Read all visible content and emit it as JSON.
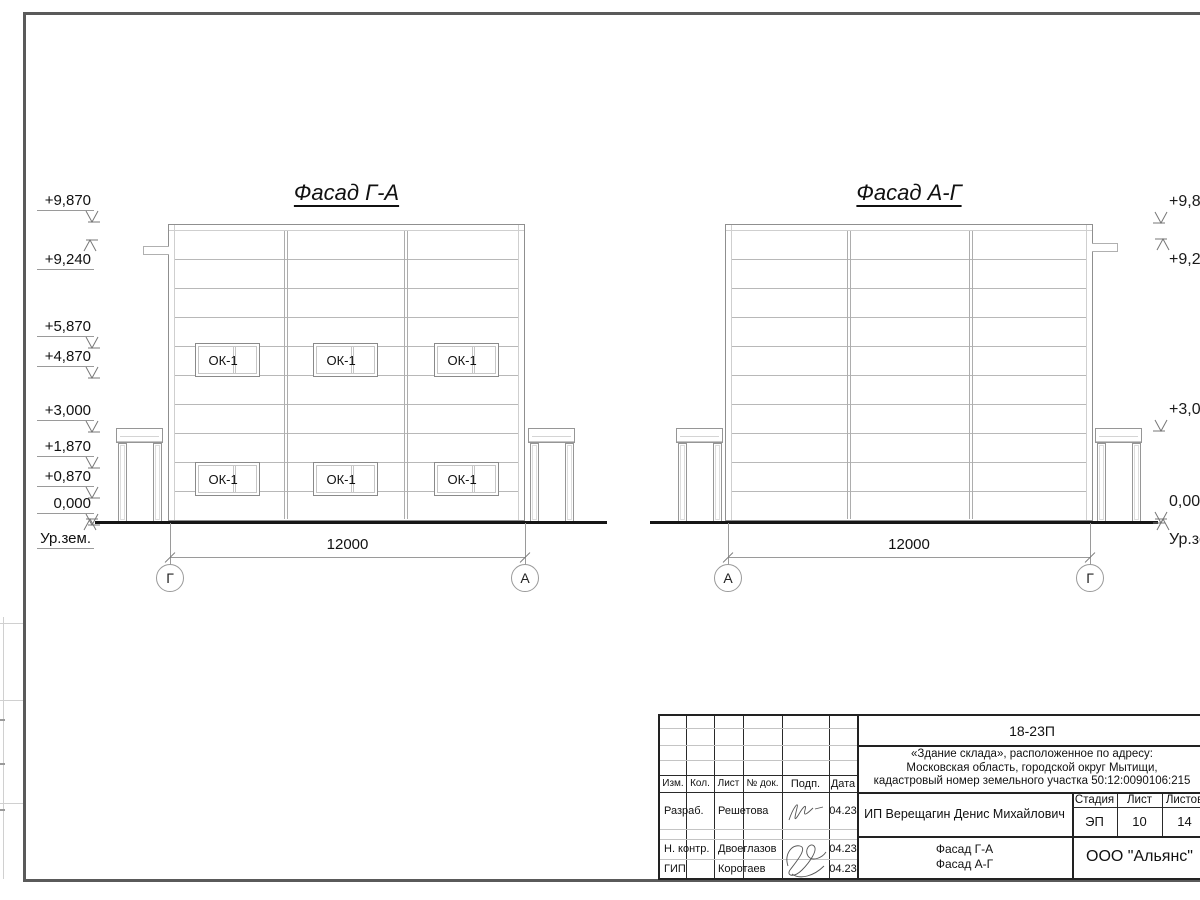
{
  "drawing": {
    "facades": [
      {
        "title": "Фасад Г-А",
        "axis_left": "Г",
        "axis_right": "А",
        "dimension": "12000",
        "window_label": "ОК-1"
      },
      {
        "title": "Фасад А-Г",
        "axis_left": "А",
        "axis_right": "Г",
        "dimension": "12000"
      }
    ],
    "elevations_left": [
      "+9,870",
      "+9,240",
      "+5,870",
      "+4,870",
      "+3,000",
      "+1,870",
      "+0,870",
      "0,000",
      "Ур.зем."
    ],
    "elevations_right": [
      "+9,870",
      "+9,240",
      "+3,000",
      "0,000",
      "Ур.зем."
    ]
  },
  "title_block": {
    "code": "18-23П",
    "project_description": "«Здание склада», расположенное по адресу:\nМосковская область, городской округ Мытищи,\nкадастровый номер земельного участка 50:12:0090106:215",
    "client": "ИП Верещагин Денис Михайлович",
    "sheet_title": "Фасад Г-А\nФасад А-Г",
    "organization": "ООО \"Альянс\"",
    "stage_label": "Стадия",
    "stage_value": "ЭП",
    "sheet_label": "Лист",
    "sheet_value": "10",
    "sheets_label": "Листов",
    "sheets_value": "14",
    "rev_columns": [
      "Изм.",
      "Кол.",
      "Лист",
      "№ док.",
      "Подп.",
      "Дата"
    ],
    "signers": [
      {
        "role": "Разраб.",
        "name": "Решетова",
        "date": "04.23"
      },
      {
        "role": "Н. контр.",
        "name": "Двоеглазов",
        "date": "04.23"
      },
      {
        "role": "ГИП",
        "name": "Коротаев",
        "date": "04.23"
      }
    ]
  }
}
